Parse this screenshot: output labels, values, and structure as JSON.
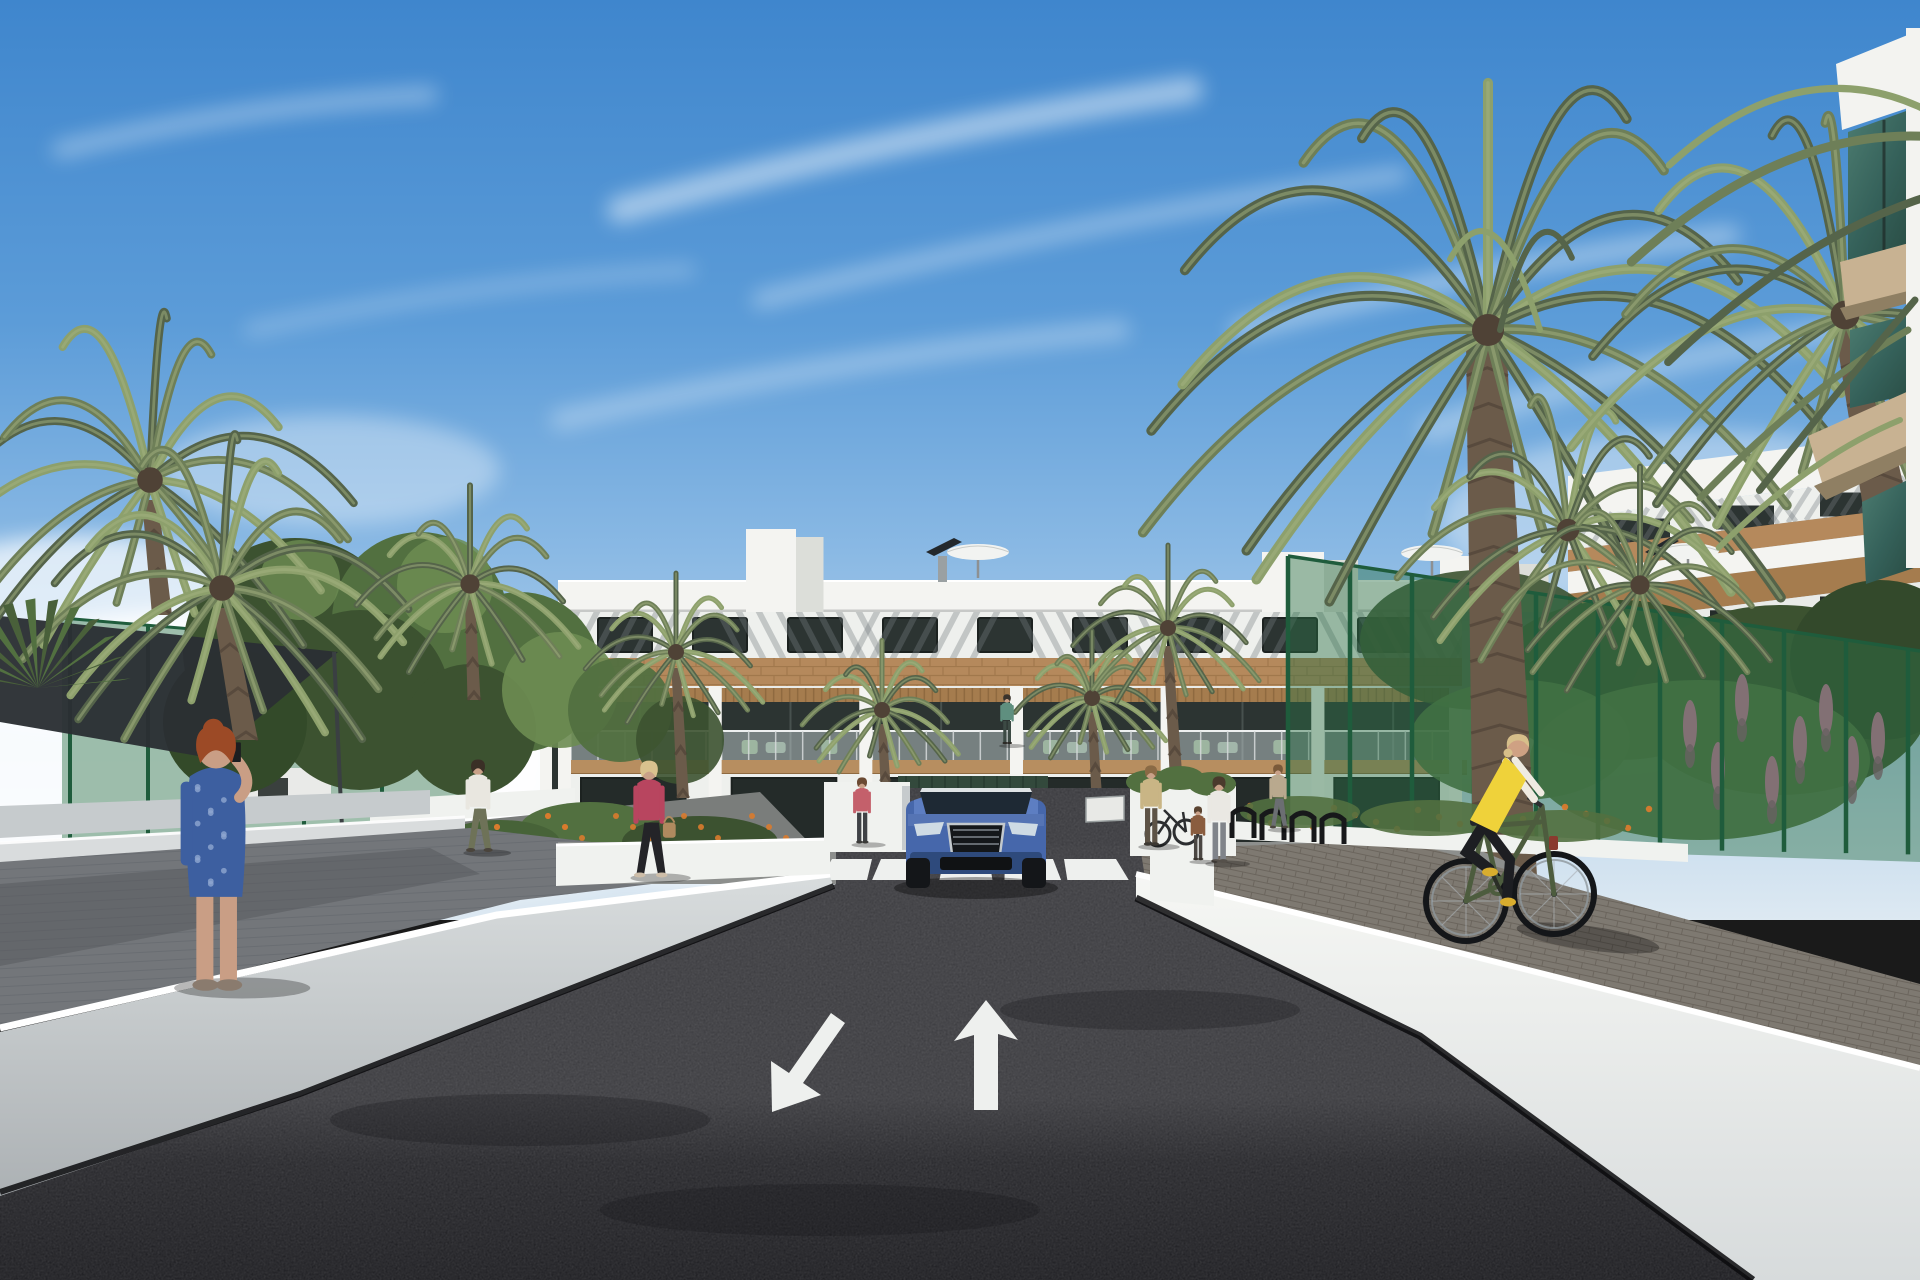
{
  "scene": {
    "title": "Sunny 3D architectural rendering of a modern white apartment complex street approach with palm trees, pedestrians, a cyclist and a blue SUV at a garage ramp",
    "type": "architectural exterior visualization",
    "time_of_day": "day, clear blue sky with thin cirrus clouds"
  },
  "colors": {
    "sky_top": "#3f86cd",
    "sky_mid": "#6ea6dc",
    "sky_low": "#a9c9e8",
    "sky_horizon": "#dce8f2",
    "cloud": "#ffffff",
    "building_white": "#f4f4f1",
    "building_shade": "#e9ebe8",
    "band_white": "#eef0ed",
    "parapet_shadow": "#c7c9c7",
    "stripe_shadow": "#767d81",
    "wood_band": "#b5895c",
    "wood_dark": "#8f6a40",
    "pergola": "#a57c4e",
    "slab_wood": "#b78e60",
    "window_dark": "#2c3432",
    "window_frame": "#1c2220",
    "opening_dark": "#242b29",
    "door_green": "#33493c",
    "garage_black": "#0d0e10",
    "glass_rail": "rgba(221,233,237,0.42)",
    "rail_post": "#d6dadb",
    "fg_glass": "#3c685e",
    "fg_glass_hi": "#5f8d80",
    "fg_slab": "#c8b292",
    "fg_slab_shade": "#8f7f63",
    "fg_white": "#f3f3f0",
    "wall_sun": "#f0f2ef",
    "wall_mid": "#d9dcdd",
    "wall_shade": "#c6cbcd",
    "cap_white": "#ffffff",
    "base_shadow": "#0a0b0d",
    "asphalt_top": "#3c3c40",
    "asphalt": "#2a2a2e",
    "asphalt_deep": "#1f1f23",
    "marking_white": "#eef0ee",
    "path_left": "#73767a",
    "path_shade": "#55585c",
    "cobble": "#7e7971",
    "cobble_line": "#5f5850",
    "fence_green": "#2d7048",
    "fence_dark": "#1f5c3c",
    "fence_mesh": "rgba(45,112,72,0.45)",
    "sail_dark": "#2b2f33",
    "leaf_dark": "#3c5230",
    "leaf_mid": "#527040",
    "leaf_light": "#6d8c52",
    "palm_dark": "#55644a",
    "palm_mid": "#6e7f58",
    "palm_light": "#8da06c",
    "palm_pale": "#a3b180",
    "trunk": "#6b5b4a",
    "trunk_dark": "#4f4236",
    "trunk_gray": "#7a6c5e",
    "flower_orange": "#d97b2e",
    "flower_pink": "#c86f9a",
    "car_blue": "#4667ab",
    "car_blue_dark": "#2e4a7c",
    "car_roof": "#5d7ec2",
    "windshield": "#1e2934",
    "chrome": "#c3c9cd",
    "grille": "#14171a",
    "headlight": "#cfdbe4",
    "tire": "#141619",
    "skin": "#c9a188",
    "umbrella_white": "#f2f3f1",
    "umbrella_shade": "#c9ccc9",
    "panel_dark": "#23282c",
    "rack_black": "#17181a"
  },
  "road": {
    "surface": "dark asphalt",
    "crosswalk_stripes": 5,
    "lane_arrows": [
      {
        "id": "arrow-left-lane",
        "direction": "down-left"
      },
      {
        "id": "arrow-right-lane",
        "direction": "up"
      }
    ],
    "ramp_arrows": [
      {
        "id": "ramp-arrow-left",
        "direction": "down-left"
      },
      {
        "id": "ramp-arrow-right",
        "direction": "up"
      }
    ]
  },
  "building": {
    "floors": 3,
    "balcony_units": 6,
    "top_windows": 9,
    "materials": [
      "white render",
      "timber brick band",
      "timber pergolas",
      "glass balustrades"
    ],
    "rooftop": {
      "umbrellas": 3,
      "solar_panels": 2,
      "stair_towers": 3
    }
  },
  "right_foreground_building": {
    "balconies": 3,
    "glass": "green tinted",
    "slab": "tan"
  },
  "vehicles": [
    {
      "id": "suv",
      "type": "SUV, front view at garage ramp",
      "color": "blue"
    }
  ],
  "street_furniture": {
    "bike_racks": 4,
    "parked_bicycles": 1,
    "ramp_sign": 1
  },
  "fences": {
    "style": "green mesh panels",
    "left_posts": 6,
    "right_posts": 11
  },
  "vegetation": {
    "palm_trees": 12,
    "deciduous_trees": 5,
    "flowers": [
      "orange",
      "pink"
    ]
  },
  "people": [
    {
      "id": "woman-on-phone",
      "desc": "red-haired woman in blue patterned dress talking on phone",
      "hair": "#9c4a26",
      "top": "#3d5fa0",
      "dot": "#8fa6d0",
      "skin": "#c99e85",
      "shoe": "#8a7b6e"
    },
    {
      "id": "man-white-shirt",
      "desc": "man in white t-shirt walking away",
      "hair": "#3a2f26",
      "top": "#e9e7e0",
      "bottom": "#6e7258",
      "shoe": "#4a443c"
    },
    {
      "id": "woman-pink-jacket",
      "desc": "blonde woman in magenta jacket with tan handbag",
      "hair": "#d9c28e",
      "top": "#b8455f",
      "bottom": "#242428",
      "bag": "#b08a5f",
      "shoe": "#cdbda8"
    },
    {
      "id": "woman-red-top",
      "desc": "woman in red top by left wall",
      "hair": "#6b4a33",
      "top": "#c4606b",
      "bottom": "#3f4246",
      "shoe": "#3a3a38"
    },
    {
      "id": "woman-by-bike-rack",
      "desc": "woman standing with bicycle at racks",
      "hair": "#8a6a45",
      "top": "#c9b585",
      "bottom": "#5d5346",
      "shoe": "#3c3832"
    },
    {
      "id": "mother-in-white",
      "desc": "woman in white shirt holding child's hand",
      "hair": "#4a3a2c",
      "top": "#eae8e3",
      "bottom": "#80848a",
      "shoe": "#55504a"
    },
    {
      "id": "child-brown",
      "desc": "child in brown top",
      "hair": "#5a4330",
      "top": "#8a5d3f",
      "bottom": "#4a4642",
      "shoe": "#3a352f"
    },
    {
      "id": "woman-strolling-right",
      "desc": "woman strolling on right walkway",
      "hair": "#7a5a3a",
      "top": "#b9a98e",
      "bottom": "#6b6e72",
      "shoe": "#4a453e"
    },
    {
      "id": "balcony-resident",
      "desc": "resident standing on first-floor balcony",
      "hair": "#3a332c",
      "top": "#5f8f7f",
      "bottom": "#3c4a44",
      "shoe": "#2c2a26"
    },
    {
      "id": "cyclist",
      "desc": "blonde cyclist in yellow vest on olive bicycle",
      "hair": "#d7bf8a",
      "top": "#efd23a",
      "sleeves": "#efebe1",
      "bottom": "#1d1e22",
      "shoe": "#d9ad2e",
      "bike": "#4d5c3e"
    }
  ]
}
